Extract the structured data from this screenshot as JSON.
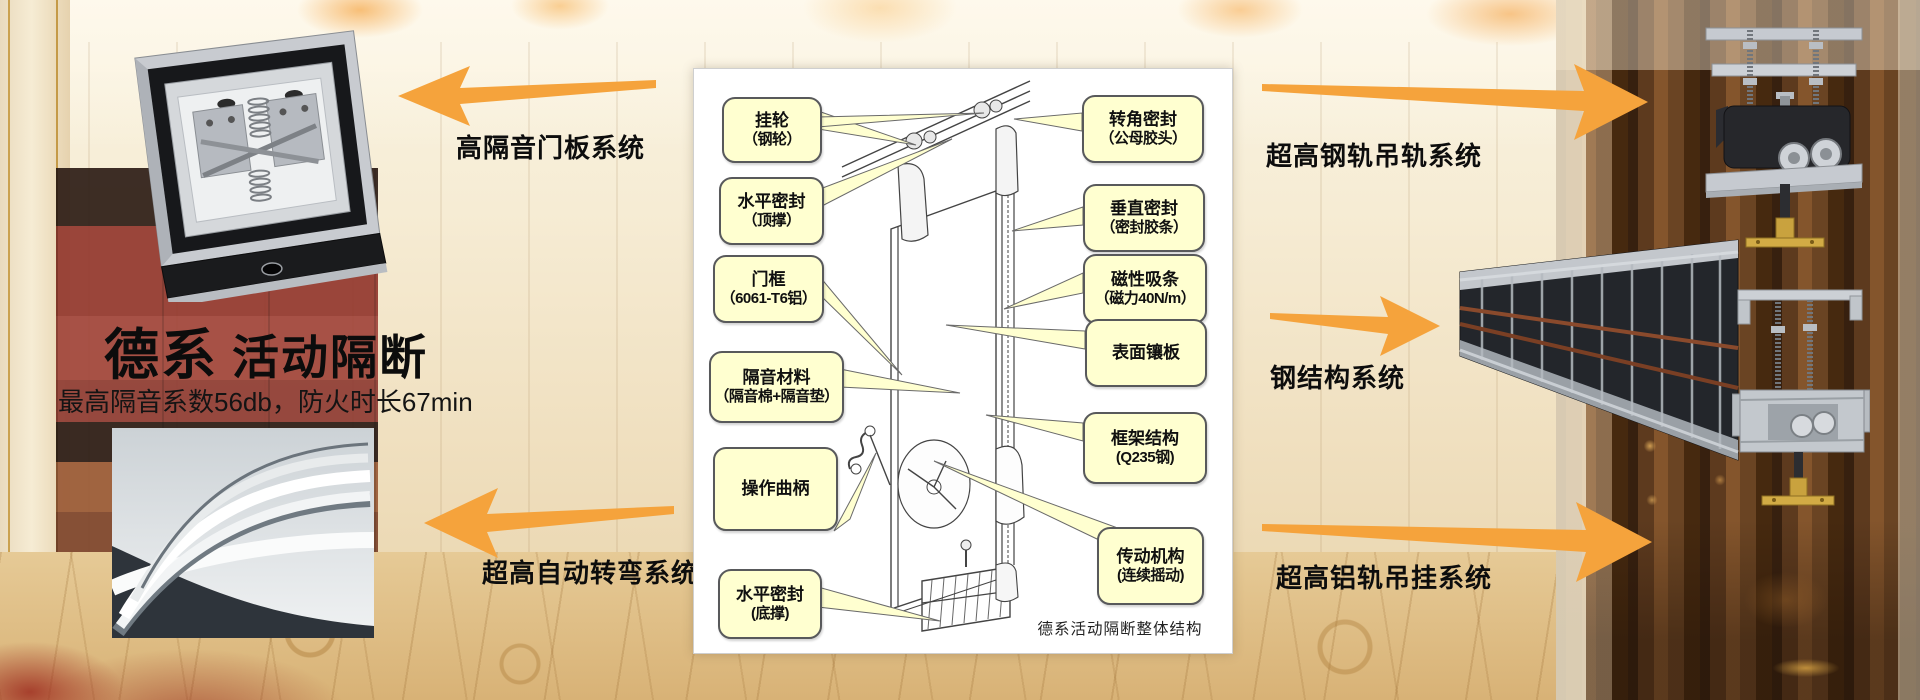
{
  "slide": {
    "title_emphasis": "德系",
    "title_rest": "活动隔断",
    "subtitle": "最高隔音系数56db，防火时长67min"
  },
  "system_labels": {
    "door_panel": "高隔音门板系统",
    "auto_turning": "超高自动转弯系统",
    "steel_rail": "超高钢轨吊轨系统",
    "steel_structure": "钢结构系统",
    "aluminum_rail": "超高铝轨吊挂系统"
  },
  "diagram": {
    "caption": "德系活动隔断整体结构",
    "callouts_left": [
      {
        "line1": "挂轮",
        "line2": "（钢轮）"
      },
      {
        "line1": "水平密封",
        "line2": "（顶撑）"
      },
      {
        "line1": "门框",
        "line2": "（6061-T6铝）"
      },
      {
        "line1": "隔音材料",
        "line2": "（隔音棉+隔音垫）"
      },
      {
        "line1": "操作曲柄",
        "line2": ""
      },
      {
        "line1": "水平密封",
        "line2": "(底撑)"
      }
    ],
    "callouts_right": [
      {
        "line1": "转角密封",
        "line2": "（公母胶头）"
      },
      {
        "line1": "垂直密封",
        "line2": "（密封胶条）"
      },
      {
        "line1": "磁性吸条",
        "line2": "（磁力40N/m）"
      },
      {
        "line1": "表面镶板",
        "line2": ""
      },
      {
        "line1": "框架结构",
        "line2": "(Q235钢)"
      },
      {
        "line1": "传动机构",
        "line2": "(连续摇动)"
      }
    ]
  },
  "images": {
    "top_left": "door-panel-mechanism-photo",
    "bottom_left": "curved-track-detail-photo",
    "top_right": "steel-rail-trolley-photo",
    "middle_right": "steel-structure-frame-photo",
    "bottom_right": "aluminum-rail-trolley-photo"
  },
  "colors": {
    "arrow_orange": "#F5A33C",
    "callout_fill": "#FFFFD0",
    "callout_border": "#58595B",
    "panel_bg": "#FFFFFF",
    "text_black": "#111111"
  }
}
